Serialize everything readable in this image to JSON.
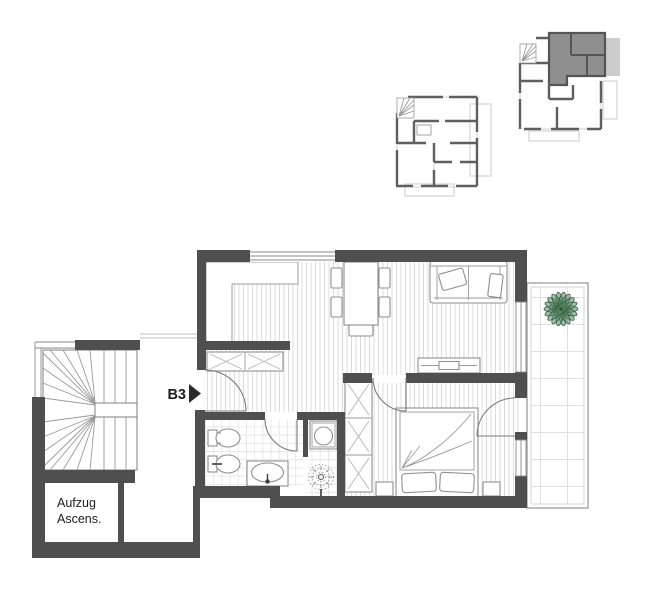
{
  "plan": {
    "unit_label": "B3",
    "elevator_label": {
      "line1": "Aufzug",
      "line2": "Ascens."
    },
    "colors": {
      "wall": "#4f4f4f",
      "furniture_line": "#8f8f8f",
      "floor_stripe": "#dcdcdc",
      "tile_line": "#e3e3e3",
      "terrace_plant": "#56815f",
      "indoor_plant": "#9a9a9a",
      "unit_highlight": "#8f8f8f",
      "mini_terrace_fill": "#cccccc",
      "mini_wall": "#5f5f5f",
      "balcony_outline": "#dadada",
      "text": "#1d1d1d"
    },
    "icons": {
      "entrance-arrow-icon": "right-pointing solid triangle",
      "staircase-icon": "winder stair fan",
      "terrace-plant-icon": "star-shaped palm plant",
      "indoor-plant-icon": "dotted round plant",
      "sofa-icon": "couch top view",
      "dining-table-icon": "table with five chairs",
      "bed-icon": "double bed with two pillows",
      "wardrobe-icon": "cabinet with cross marks",
      "toilet-icon": "wall hung wc",
      "bidet-icon": "wall hung bidet",
      "washbasin-icon": "oval basin in counter",
      "washing-machine-icon": "square with drum circle"
    }
  }
}
